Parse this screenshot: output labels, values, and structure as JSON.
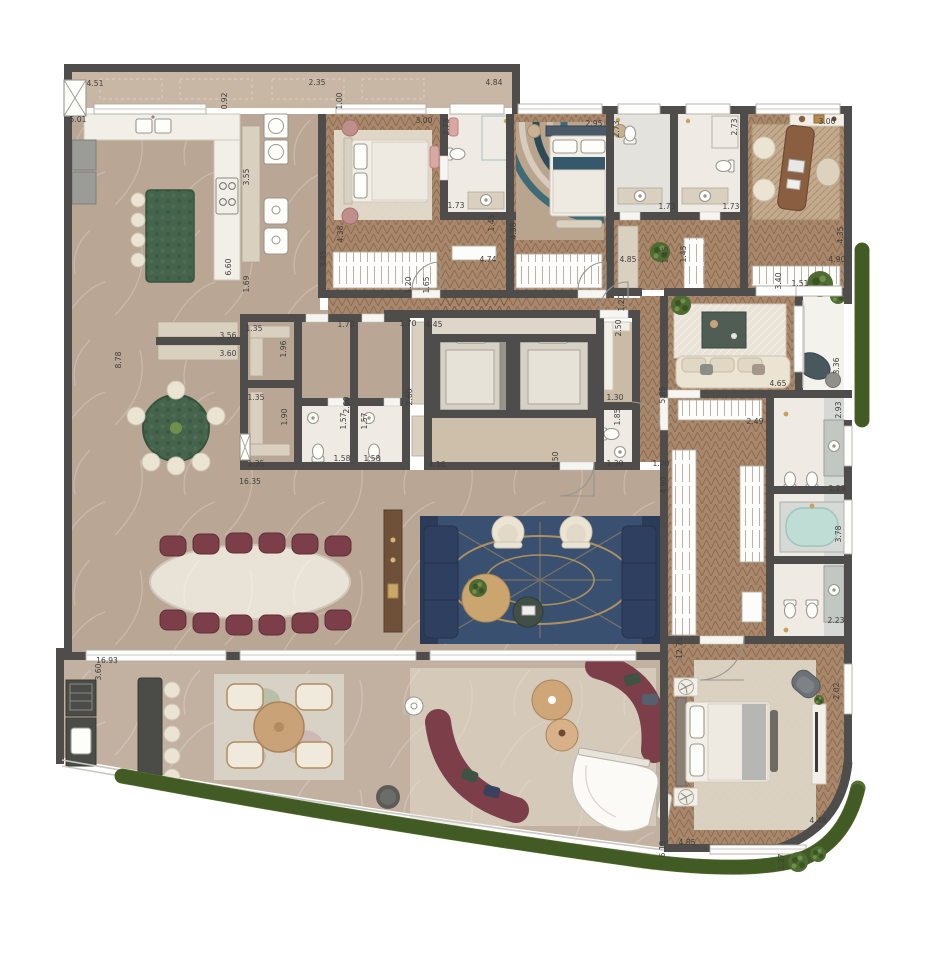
{
  "plan": {
    "type": "residential-floor-plan",
    "units": "meters"
  },
  "colors": {
    "wall": "#4e4d4b",
    "marble": "#b9a694",
    "marbleLight": "#c9b7a6",
    "wood": "#a8876a",
    "terrace": "#c2b1a0",
    "bath": "#efeae3",
    "bathGray": "#e3e2dc",
    "white": "#f4f2ed",
    "elevator": "#98948b",
    "hedge": "#55702f",
    "hedgeDark": "#3c5422",
    "island": "#44644d",
    "counter": "#f2efe8",
    "cabinet": "#d9d0c0",
    "navy": "#2e3f5f",
    "navyDark": "#24324d",
    "burgundy": "#7c3e49",
    "rugBlue": "#3a5070",
    "rugBand": "#2b3c59",
    "gold": "#c8a05c",
    "cream": "#ece4d3",
    "barDark": "#4b4b47",
    "tub": "#bfdcd5",
    "deskWood": "#8a5f41",
    "pink": "#d9a8a5",
    "dim": "#3f3e3c",
    "glass": "#c9c7c2",
    "fixture": "#9a978e"
  },
  "dimensions": [
    {
      "t": "4.51",
      "x": 95,
      "y": 86,
      "r": 0
    },
    {
      "t": "2.35",
      "x": 317,
      "y": 85,
      "r": 0
    },
    {
      "t": "0.92",
      "x": 227,
      "y": 101,
      "r": -90
    },
    {
      "t": "5.01",
      "x": 78,
      "y": 122,
      "r": 0
    },
    {
      "t": "4.84",
      "x": 494,
      "y": 85,
      "r": 0
    },
    {
      "t": "1.00",
      "x": 342,
      "y": 101,
      "r": -90
    },
    {
      "t": "3.00",
      "x": 424,
      "y": 123,
      "r": 0
    },
    {
      "t": "2.73",
      "x": 449,
      "y": 127,
      "r": -90
    },
    {
      "t": "1.73",
      "x": 456,
      "y": 208,
      "r": 0
    },
    {
      "t": "1.45",
      "x": 494,
      "y": 223,
      "r": -90
    },
    {
      "t": "2.95",
      "x": 594,
      "y": 126,
      "r": 0
    },
    {
      "t": "2.73",
      "x": 619,
      "y": 129,
      "r": -90
    },
    {
      "t": "1.73",
      "x": 667,
      "y": 209,
      "r": 0
    },
    {
      "t": "1.73",
      "x": 731,
      "y": 209,
      "r": 0
    },
    {
      "t": "3.00",
      "x": 827,
      "y": 124,
      "r": 0
    },
    {
      "t": "2.73",
      "x": 737,
      "y": 127,
      "r": -90
    },
    {
      "t": "3.55",
      "x": 249,
      "y": 177,
      "r": -90
    },
    {
      "t": "6.60",
      "x": 231,
      "y": 267,
      "r": -90
    },
    {
      "t": "1.69",
      "x": 249,
      "y": 284,
      "r": -90
    },
    {
      "t": "3.85",
      "x": 326,
      "y": 259,
      "r": -90
    },
    {
      "t": "4.38",
      "x": 343,
      "y": 234,
      "r": -90
    },
    {
      "t": "4.38",
      "x": 516,
      "y": 231,
      "r": -90
    },
    {
      "t": "4.74",
      "x": 488,
      "y": 262,
      "r": 0
    },
    {
      "t": "4.85",
      "x": 628,
      "y": 262,
      "r": 0
    },
    {
      "t": "4.90",
      "x": 837,
      "y": 262,
      "r": 0
    },
    {
      "t": "4.35",
      "x": 843,
      "y": 235,
      "r": -90
    },
    {
      "t": "1.45",
      "x": 668,
      "y": 255,
      "r": -90
    },
    {
      "t": "1.45",
      "x": 686,
      "y": 254,
      "r": -90
    },
    {
      "t": "1.20",
      "x": 411,
      "y": 285,
      "r": -90
    },
    {
      "t": "1.65",
      "x": 429,
      "y": 285,
      "r": -90
    },
    {
      "t": "1.20",
      "x": 624,
      "y": 303,
      "r": -90
    },
    {
      "t": "1.51",
      "x": 800,
      "y": 286,
      "r": 0
    },
    {
      "t": "3.40",
      "x": 781,
      "y": 281,
      "r": -90
    },
    {
      "t": "1.35",
      "x": 254,
      "y": 331,
      "r": 0
    },
    {
      "t": "3.56",
      "x": 228,
      "y": 338,
      "r": 0
    },
    {
      "t": "1.70",
      "x": 346,
      "y": 327,
      "r": 0
    },
    {
      "t": "1.70",
      "x": 408,
      "y": 326,
      "r": 0
    },
    {
      "t": "4.45",
      "x": 434,
      "y": 327,
      "r": 0
    },
    {
      "t": "3.60",
      "x": 228,
      "y": 356,
      "r": 0
    },
    {
      "t": "1.96",
      "x": 286,
      "y": 349,
      "r": -90
    },
    {
      "t": "8.78",
      "x": 121,
      "y": 360,
      "r": -90
    },
    {
      "t": "1.35",
      "x": 256,
      "y": 400,
      "r": 0
    },
    {
      "t": "1.90",
      "x": 287,
      "y": 417,
      "r": -90
    },
    {
      "t": "2.60",
      "x": 349,
      "y": 405,
      "r": -90
    },
    {
      "t": "2.60",
      "x": 412,
      "y": 397,
      "r": -90
    },
    {
      "t": "2.50",
      "x": 621,
      "y": 328,
      "r": -90
    },
    {
      "t": "1.57",
      "x": 346,
      "y": 421,
      "r": -90
    },
    {
      "t": "1.57",
      "x": 367,
      "y": 421,
      "r": -90
    },
    {
      "t": "1.30",
      "x": 615,
      "y": 400,
      "r": 0
    },
    {
      "t": "1.85",
      "x": 620,
      "y": 417,
      "r": -90
    },
    {
      "t": "5.85",
      "x": 665,
      "y": 395,
      "r": -90
    },
    {
      "t": "1.35",
      "x": 256,
      "y": 466,
      "r": 0
    },
    {
      "t": "1.58",
      "x": 342,
      "y": 461,
      "r": 0
    },
    {
      "t": "1.58",
      "x": 372,
      "y": 461,
      "r": 0
    },
    {
      "t": "16.35",
      "x": 250,
      "y": 484,
      "r": 0
    },
    {
      "t": "4.16",
      "x": 437,
      "y": 467,
      "r": 0
    },
    {
      "t": "1.50",
      "x": 558,
      "y": 460,
      "r": -90
    },
    {
      "t": "1.30",
      "x": 615,
      "y": 466,
      "r": 0
    },
    {
      "t": "1.20",
      "x": 661,
      "y": 466,
      "r": 0
    },
    {
      "t": "4.90",
      "x": 666,
      "y": 485,
      "r": -90
    },
    {
      "t": "3.36",
      "x": 839,
      "y": 366,
      "r": -90
    },
    {
      "t": "4.65",
      "x": 778,
      "y": 386,
      "r": 0
    },
    {
      "t": "2.93",
      "x": 841,
      "y": 410,
      "r": -90
    },
    {
      "t": "2.49",
      "x": 755,
      "y": 424,
      "r": 0
    },
    {
      "t": "2.23",
      "x": 837,
      "y": 491,
      "r": 0
    },
    {
      "t": "3.78",
      "x": 841,
      "y": 534,
      "r": -90
    },
    {
      "t": "2.23",
      "x": 836,
      "y": 623,
      "r": 0
    },
    {
      "t": "12.75",
      "x": 682,
      "y": 648,
      "r": -90
    },
    {
      "t": "2.02",
      "x": 839,
      "y": 691,
      "r": -90
    },
    {
      "t": "16.93",
      "x": 107,
      "y": 663,
      "r": 0
    },
    {
      "t": "3.60",
      "x": 101,
      "y": 672,
      "r": -90
    },
    {
      "t": "6.15",
      "x": 665,
      "y": 849,
      "r": -90
    },
    {
      "t": "4.85",
      "x": 687,
      "y": 845,
      "r": 0
    },
    {
      "t": "4.48",
      "x": 818,
      "y": 823,
      "r": 0
    },
    {
      "t": "1.27",
      "x": 784,
      "y": 862,
      "r": -90
    }
  ]
}
